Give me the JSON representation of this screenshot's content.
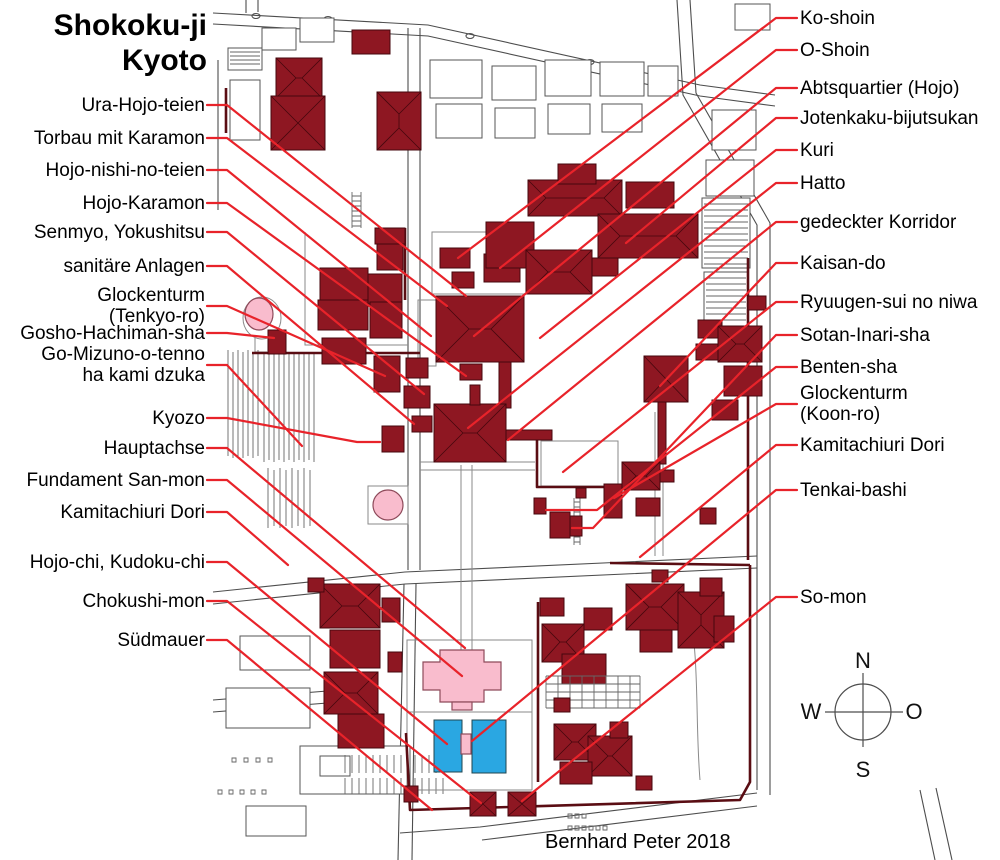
{
  "title": {
    "line1": "Shokoku-ji",
    "line2": "Kyoto"
  },
  "attribution": "Bernhard Peter 2018",
  "compass": {
    "n": "N",
    "s": "S",
    "w": "W",
    "o": "O"
  },
  "colors": {
    "building": "#8e1722",
    "building_outline": "#45070d",
    "wall": "#5a0d13",
    "leader": "#e8232a",
    "highlight_pink": "#f9bccd",
    "water_blue": "#2aa7e2",
    "street": "#4d4d4d"
  },
  "labels": {
    "left": [
      {
        "id": "ura-hojo-teien",
        "lines": [
          "Ura-Hojo-teien"
        ],
        "y": 105,
        "target": [
          466,
          296
        ]
      },
      {
        "id": "torbau-mit-karamon",
        "lines": [
          "Torbau mit Karamon"
        ],
        "y": 138,
        "target": [
          447,
          306
        ]
      },
      {
        "id": "hojo-nishi-no-teien",
        "lines": [
          "Hojo-nishi-no-teien"
        ],
        "y": 170,
        "target": [
          431,
          336
        ]
      },
      {
        "id": "hojo-karamon",
        "lines": [
          "Hojo-Karamon"
        ],
        "y": 203,
        "target": [
          466,
          376
        ]
      },
      {
        "id": "senmyo-yokushitsu",
        "lines": [
          "Senmyo, Yokushitsu"
        ],
        "y": 232,
        "target": [
          424,
          394
        ]
      },
      {
        "id": "sanitaere-anlagen",
        "lines": [
          "sanitäre Anlagen"
        ],
        "y": 266,
        "target": [
          414,
          424
        ]
      },
      {
        "id": "glockenturm-tenkyo-ro",
        "lines": [
          "Glockenturm",
          "(Tenkyo-ro)"
        ],
        "y": 306,
        "target": [
          385,
          376
        ]
      },
      {
        "id": "gosho-hachiman-sha",
        "lines": [
          "Gosho-Hachiman-sha"
        ],
        "y": 333,
        "target": [
          274,
          338
        ]
      },
      {
        "id": "go-mizuno-o-tenno",
        "lines": [
          "Go-Mizuno-o-tenno",
          "ha kami dzuka"
        ],
        "y": 365,
        "target": [
          302,
          446
        ]
      },
      {
        "id": "kyozo",
        "lines": [
          "Kyozo"
        ],
        "y": 418,
        "target": [
          357,
          442
        ],
        "end": 380
      },
      {
        "id": "hauptachse",
        "lines": [
          "Hauptachse"
        ],
        "y": 448,
        "target": [
          465,
          648
        ]
      },
      {
        "id": "fundament-san-mon",
        "lines": [
          "Fundament San-mon"
        ],
        "y": 480,
        "target": [
          462,
          676
        ]
      },
      {
        "id": "kamitachiuri-dori-west",
        "lines": [
          "Kamitachiuri Dori"
        ],
        "y": 512,
        "target": [
          288,
          565
        ]
      },
      {
        "id": "hojo-chi-kudoku-chi",
        "lines": [
          "Hojo-chi, Kudoku-chi"
        ],
        "y": 562,
        "target": [
          447,
          744
        ]
      },
      {
        "id": "chokushi-mon",
        "lines": [
          "Chokushi-mon"
        ],
        "y": 601,
        "target": [
          481,
          803
        ]
      },
      {
        "id": "suedmauer",
        "lines": [
          "Südmauer"
        ],
        "y": 640,
        "target": [
          432,
          810
        ]
      }
    ],
    "right": [
      {
        "id": "ko-shoin",
        "lines": [
          "Ko-shoin"
        ],
        "y": 18,
        "target": [
          458,
          258
        ]
      },
      {
        "id": "o-shoin",
        "lines": [
          "O-Shoin"
        ],
        "y": 50,
        "target": [
          500,
          268
        ]
      },
      {
        "id": "abtsquartier-hojo",
        "lines": [
          "Abtsquartier (Hojo)"
        ],
        "y": 88,
        "target": [
          474,
          336
        ]
      },
      {
        "id": "jotenkaku-bijutsukan",
        "lines": [
          "Jotenkaku-bijutsukan"
        ],
        "y": 118,
        "target": [
          626,
          243
        ]
      },
      {
        "id": "kuri",
        "lines": [
          "Kuri"
        ],
        "y": 150,
        "target": [
          540,
          338
        ]
      },
      {
        "id": "hatto",
        "lines": [
          "Hatto"
        ],
        "y": 183,
        "target": [
          468,
          428
        ]
      },
      {
        "id": "gedeckter-korridor",
        "lines": [
          "gedeckter Korridor"
        ],
        "y": 222,
        "target": [
          508,
          440
        ]
      },
      {
        "id": "kaisan-do",
        "lines": [
          "Kaisan-do"
        ],
        "y": 263,
        "target": [
          660,
          386
        ]
      },
      {
        "id": "ryuugen-sui-no-niwa",
        "lines": [
          "Ryuugen-sui no niwa"
        ],
        "y": 302,
        "target": [
          563,
          472
        ]
      },
      {
        "id": "sotan-inari-sha",
        "lines": [
          "Sotan-Inari-sha"
        ],
        "y": 335,
        "target": [
          593,
          528
        ],
        "end": 572
      },
      {
        "id": "benten-sha",
        "lines": [
          "Benten-sha"
        ],
        "y": 367,
        "target": [
          597,
          510
        ],
        "end": 546
      },
      {
        "id": "glockenturm-koon-ro",
        "lines": [
          "Glockenturm",
          "(Koon-ro)"
        ],
        "y": 404,
        "target": [
          614,
          498
        ]
      },
      {
        "id": "kamitachiuri-dori-ost",
        "lines": [
          "Kamitachiuri Dori"
        ],
        "y": 445,
        "target": [
          640,
          557
        ]
      },
      {
        "id": "tenkai-bashi",
        "lines": [
          "Tenkai-bashi"
        ],
        "y": 490,
        "target": [
          472,
          741
        ]
      },
      {
        "id": "so-mon",
        "lines": [
          "So-mon"
        ],
        "y": 597,
        "target": [
          522,
          801
        ]
      }
    ]
  }
}
